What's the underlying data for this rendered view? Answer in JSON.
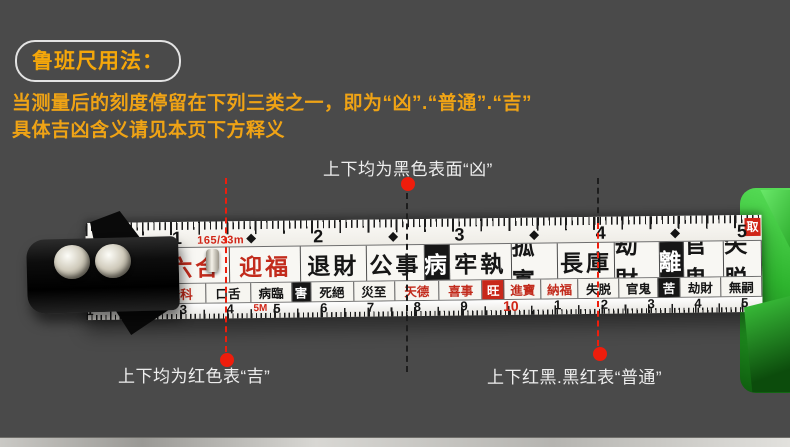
{
  "header": {
    "badge": "鲁班尺用法：",
    "line1": "当测量后的刻度停留在下列三类之一，即为“凶”.“普通”.“吉”",
    "line2": "具体吉凶含义请见本页下方释义"
  },
  "annotations": {
    "black_label": "上下均为黑色表面“凶”",
    "red_label": "上下均为红色表“吉”",
    "mixed_label": "上下红黑.黑红表“普通”"
  },
  "tape": {
    "model_text": "165/33m",
    "marker_5m": "5M",
    "corner_badge": "取",
    "top_scale": [
      "1",
      "2",
      "3",
      "4",
      "5"
    ],
    "bottom_scale": [
      "1",
      "2",
      "3",
      "4",
      "5",
      "6",
      "7",
      "8",
      "9",
      "10",
      "1",
      "2",
      "3",
      "4",
      "5"
    ],
    "main_row": [
      {
        "text": "庫",
        "style": "red",
        "w": 58
      },
      {
        "text": "財",
        "style": "red-box",
        "w": 26
      },
      {
        "text": "六合",
        "style": "red",
        "w": 78
      },
      {
        "text": "迎福",
        "style": "red",
        "w": 80
      },
      {
        "text": "退財",
        "style": "black",
        "w": 74
      },
      {
        "text": "公事",
        "style": "black",
        "w": 66
      },
      {
        "text": "病",
        "style": "black-box",
        "w": 27
      },
      {
        "text": "牢執",
        "style": "black",
        "w": 70
      },
      {
        "text": "孤寡",
        "style": "black",
        "w": 52
      },
      {
        "text": "長庫",
        "style": "black",
        "w": 64
      },
      {
        "text": "劫財",
        "style": "black",
        "w": 50
      },
      {
        "text": "離",
        "style": "black-box",
        "w": 27
      },
      {
        "text": "官鬼",
        "style": "black",
        "w": 45
      },
      {
        "text": "失脱",
        "style": "black",
        "w": 42
      }
    ],
    "sub_row": [
      {
        "text": "丁",
        "style": "red-box",
        "w": 17
      },
      {
        "text": "財旺",
        "style": "red",
        "w": 50
      },
      {
        "text": "登科",
        "style": "red",
        "w": 50
      },
      {
        "text": "口舌",
        "style": "black",
        "w": 44
      },
      {
        "text": "病臨",
        "style": "black",
        "w": 40
      },
      {
        "text": "害",
        "style": "black-box",
        "w": 18
      },
      {
        "text": "死絕",
        "style": "black",
        "w": 42
      },
      {
        "text": "災至",
        "style": "black",
        "w": 40
      },
      {
        "text": "天德",
        "style": "red",
        "w": 44
      },
      {
        "text": "喜事",
        "style": "red",
        "w": 42
      },
      {
        "text": "旺",
        "style": "red-box",
        "w": 21
      },
      {
        "text": "進寶",
        "style": "red",
        "w": 36
      },
      {
        "text": "納福",
        "style": "red",
        "w": 36
      },
      {
        "text": "失脱",
        "style": "black",
        "w": 40
      },
      {
        "text": "官鬼",
        "style": "black",
        "w": 38
      },
      {
        "text": "苦",
        "style": "black-box",
        "w": 21
      },
      {
        "text": "劫財",
        "style": "black",
        "w": 40
      },
      {
        "text": "無嗣",
        "style": "black",
        "w": 40
      }
    ]
  },
  "colors": {
    "background": "#4a4a4a",
    "gold_text": "#efa315",
    "white_text": "#ededed",
    "annotation_red": "#ee1d0c",
    "tape_red": "#c8281a",
    "tape_black": "#161616",
    "case_green": "#2eb42e"
  }
}
